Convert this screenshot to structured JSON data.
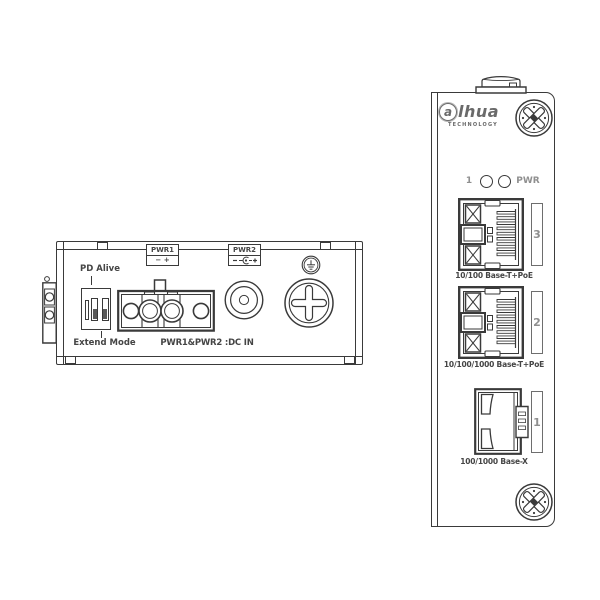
{
  "left_device": {
    "labels": {
      "pd_alive": "PD Alive",
      "extend_mode": "Extend Mode",
      "dc_in": "PWR1&PWR2 :DC IN"
    },
    "pwr1": {
      "title": "PWR1",
      "polarity": "−  +"
    },
    "pwr2": {
      "title": "PWR2"
    }
  },
  "right_device": {
    "logo": {
      "first": "a",
      "rest": "lhua",
      "sub": "TECHNOLOGY"
    },
    "leds": {
      "left_label": "1",
      "right_label": "PWR"
    },
    "ports": [
      {
        "number": "3",
        "label": "10/100 Base-T+PoE",
        "type": "rj45"
      },
      {
        "number": "2",
        "label": "10/100/1000 Base-T+PoE",
        "type": "rj45"
      },
      {
        "number": "1",
        "label": "100/1000 Base-X",
        "type": "sfp"
      }
    ]
  },
  "colors": {
    "line": "#3a3a3a",
    "text": "#454545",
    "gray": "#8f8f8f",
    "background": "#ffffff"
  }
}
